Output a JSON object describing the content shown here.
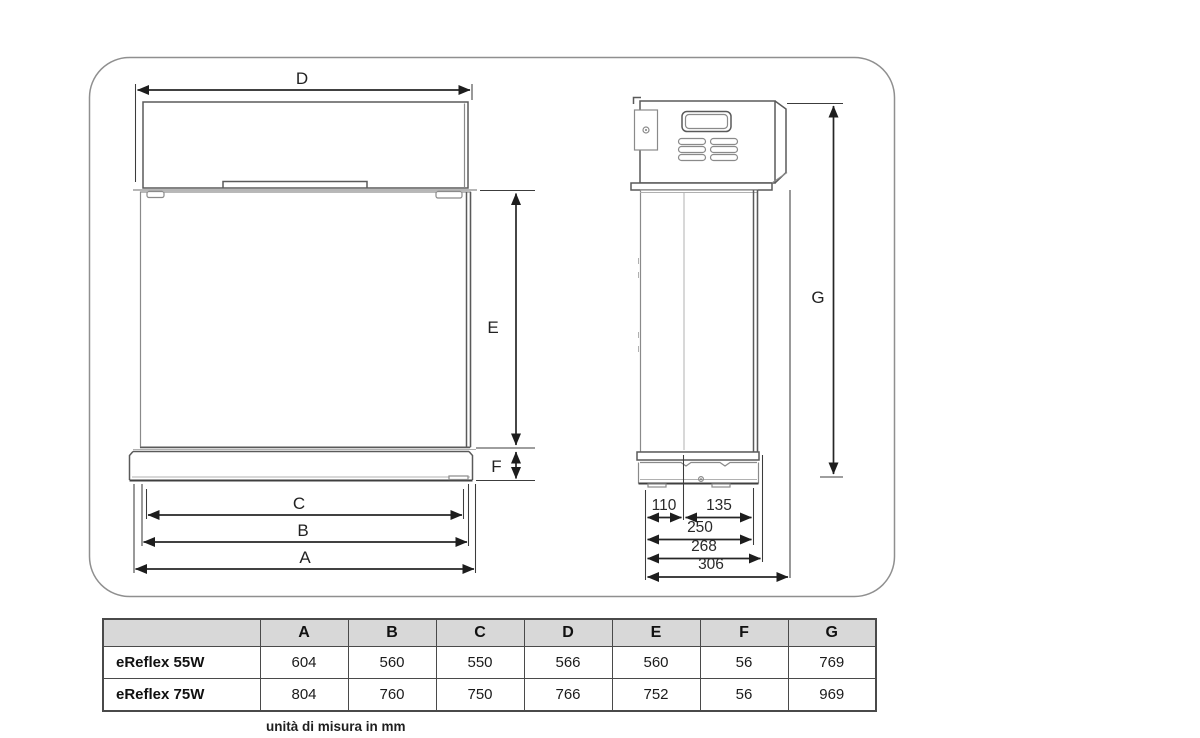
{
  "diagram": {
    "border_color": "#8f8f8f",
    "line_color": "#4a4a4a",
    "dims": {
      "d": "D",
      "e": "E",
      "f": "F",
      "c": "C",
      "b": "B",
      "a": "A",
      "g": "G",
      "n110": "110",
      "n135": "135",
      "n250": "250",
      "n268": "268",
      "n306": "306"
    }
  },
  "table": {
    "header_bg": "#d8d8d8",
    "columns": [
      "A",
      "B",
      "C",
      "D",
      "E",
      "F",
      "G"
    ],
    "rows": [
      {
        "label": "eReflex 55W",
        "values": [
          "604",
          "560",
          "550",
          "566",
          "560",
          "56",
          "769"
        ]
      },
      {
        "label": "eReflex 75W",
        "values": [
          "804",
          "760",
          "750",
          "766",
          "752",
          "56",
          "969"
        ]
      }
    ]
  },
  "caption": "unità di misura in mm"
}
